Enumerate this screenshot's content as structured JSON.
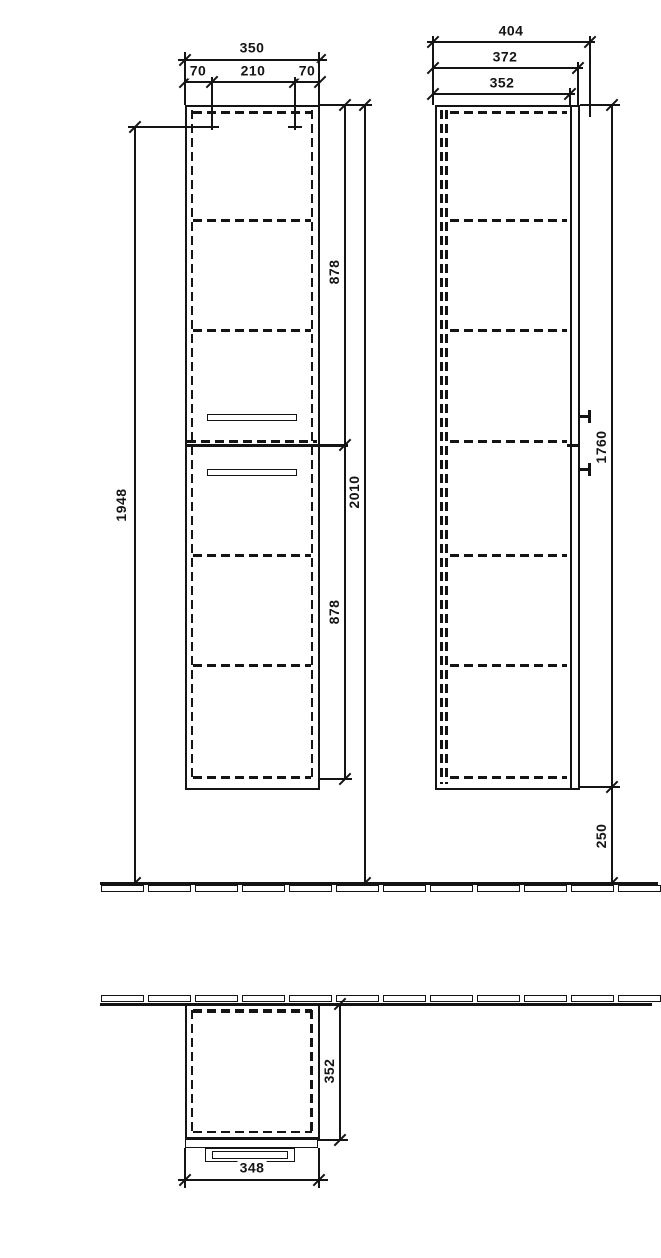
{
  "drawing": {
    "front": {
      "overall_width": "350",
      "hole_offset_left": "70",
      "hole_spacing": "210",
      "hole_offset_right": "70",
      "mounting_height": "1948",
      "upper_section_height": "878",
      "lower_section_height": "878",
      "overall_height": "2010"
    },
    "side": {
      "overall_depth": "404",
      "depth_with_front": "372",
      "carcass_depth": "352",
      "cabinet_height": "1760",
      "floor_clearance": "250"
    },
    "top": {
      "carcass_depth": "352",
      "front_width": "348"
    }
  }
}
